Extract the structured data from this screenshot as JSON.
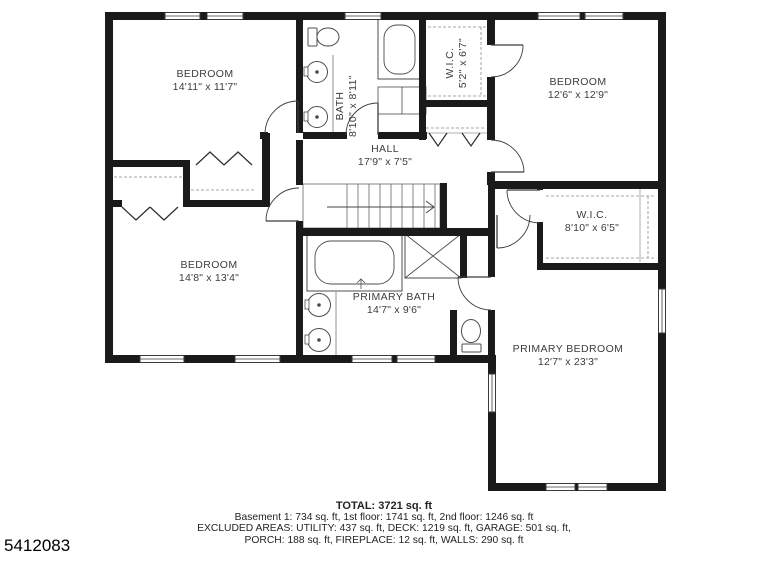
{
  "floor_plan": {
    "rooms": [
      {
        "id": "bedroom-top-left",
        "name": "BEDROOM",
        "dims": "14'11\" x 11'7\""
      },
      {
        "id": "bath",
        "name": "BATH",
        "dims": "8'10\" x 8'11\""
      },
      {
        "id": "wic-small",
        "name": "W.I.C.",
        "dims": "5'2\" x 6'7\""
      },
      {
        "id": "bedroom-top-right",
        "name": "BEDROOM",
        "dims": "12'6\" x 12'9\""
      },
      {
        "id": "hall",
        "name": "HALL",
        "dims": "17'9\" x 7'5\""
      },
      {
        "id": "wic-primary",
        "name": "W.I.C.",
        "dims": "8'10\" x 6'5\""
      },
      {
        "id": "bedroom-bottom-left",
        "name": "BEDROOM",
        "dims": "14'8\" x 13'4\""
      },
      {
        "id": "primary-bath",
        "name": "PRIMARY BATH",
        "dims": "14'7\" x 9'6\""
      },
      {
        "id": "primary-bedroom",
        "name": "PRIMARY BEDROOM",
        "dims": "12'7\" x 23'3\""
      }
    ]
  },
  "summary": {
    "total": "TOTAL: 3721 sq. ft",
    "floors": "Basement 1: 734 sq. ft, 1st floor: 1741 sq. ft, 2nd floor: 1246 sq. ft",
    "excluded_1": "EXCLUDED AREAS: UTILITY: 437 sq. ft, DECK: 1219 sq. ft, GARAGE: 501 sq. ft,",
    "excluded_2": "PORCH: 188 sq. ft, FIREPLACE: 12 sq. ft, WALLS: 290 sq. ft"
  },
  "listing_id": "5412083",
  "colors": {
    "wall": "#1a1a1a",
    "thin_line": "#555555",
    "dashed_line": "#8a8a8a",
    "text": "#3d3d3d"
  }
}
